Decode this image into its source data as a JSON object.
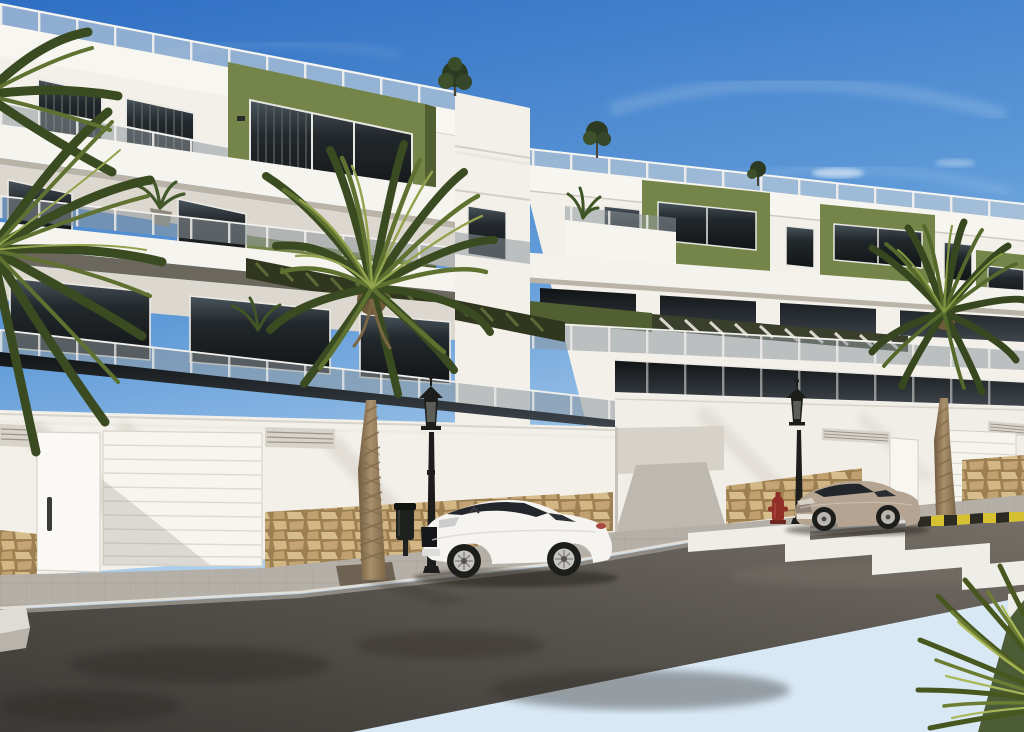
{
  "meta": {
    "kind": "architectural-render-photo",
    "description": "New-build white apartment complex with olive-green accent volumes, glass balconies, roof terraces, street with parked coupes, zebra crossing and palm trees under a blue sky",
    "visible_text": []
  },
  "colors": {
    "sky_top": "#2f6fc3",
    "sky_mid": "#6ea4dc",
    "sky_horizon": "#cfe3f2",
    "wall_white": "#f3f0ea",
    "wall_shade": "#ddd8cf",
    "accent_green": "#75854a",
    "accent_green_dark": "#525f33",
    "glass_dark": "#191d20",
    "railing_glass": "#8e979d",
    "railing_post": "#f4f2ee",
    "pergola_dark": "#31371f",
    "stone_tan": "#c9a96f",
    "stone_grout": "#96784e",
    "road_asphalt": "#5c5750",
    "road_dark": "#3b3734",
    "sidewalk_far": "#b4afa7",
    "sidewalk_near": "#cbc6be",
    "crosswalk_white": "#efede7",
    "curb_yellow": "#d6c133",
    "curb_black": "#2b2a23",
    "palm_dark": "#3a4a21",
    "palm_mid": "#5f7130",
    "palm_light": "#93a24c",
    "trunk_brown": "#9a8262",
    "car_white": "#f5f4f1",
    "car_beige": "#b4a491",
    "lamp_black": "#1d1d1b",
    "hydrant_red": "#8f2f28"
  },
  "scene": {
    "sky": {
      "clouds": "thin cirrus wisps upper right"
    },
    "buildings": [
      {
        "name": "left-apartment-block",
        "floors_visible": 3,
        "features": [
          "roof terrace with glass balustrade",
          "olive-green accent volume with glass band",
          "white balcony parapets",
          "tinted glass railings",
          "dark pergola louvers",
          "garage wall with sectional door and pedestrian door",
          "ventilation grilles",
          "natural stone base"
        ]
      },
      {
        "name": "right-apartment-block",
        "floors_visible": 3,
        "features": [
          "roof terrace with glass balustrade",
          "three olive-green accent volumes",
          "white balcony boxes",
          "light pergola louvers",
          "street wall with garage door and narrow door",
          "stone base sections",
          "rooftop shrubs"
        ]
      }
    ],
    "vehicles": [
      {
        "name": "white-coupe",
        "description": "white sports coupe parked facing left at kerb"
      },
      {
        "name": "beige-coupe",
        "description": "beige coupe parked facing left near crossing"
      }
    ],
    "street": {
      "crosswalk_stripes": 5,
      "hazard_curb": "yellow and black striped kerb at right",
      "sidewalk_far": "grey paver sidewalk along buildings",
      "sidewalk_near": "light paver sidewalk bottom right",
      "driveway": "ramp entrance between the two blocks"
    },
    "street_furniture": [
      {
        "name": "street-lamp",
        "count": 2,
        "style": "black ornate lantern"
      },
      {
        "name": "litter-bin",
        "count": 1
      },
      {
        "name": "fire-hydrant",
        "count": 1,
        "color": "red"
      }
    ],
    "vegetation": [
      {
        "name": "center-palm",
        "position": "in front of left block"
      },
      {
        "name": "right-palm",
        "position": "in front of right block"
      },
      {
        "name": "left-edge-palm",
        "position": "dark palm at left edge"
      },
      {
        "name": "corner-fronds",
        "position": "bright fronds bottom right corner"
      },
      {
        "name": "rooftop-trees",
        "count": 3
      },
      {
        "name": "balcony-plants",
        "count": 5
      }
    ]
  }
}
